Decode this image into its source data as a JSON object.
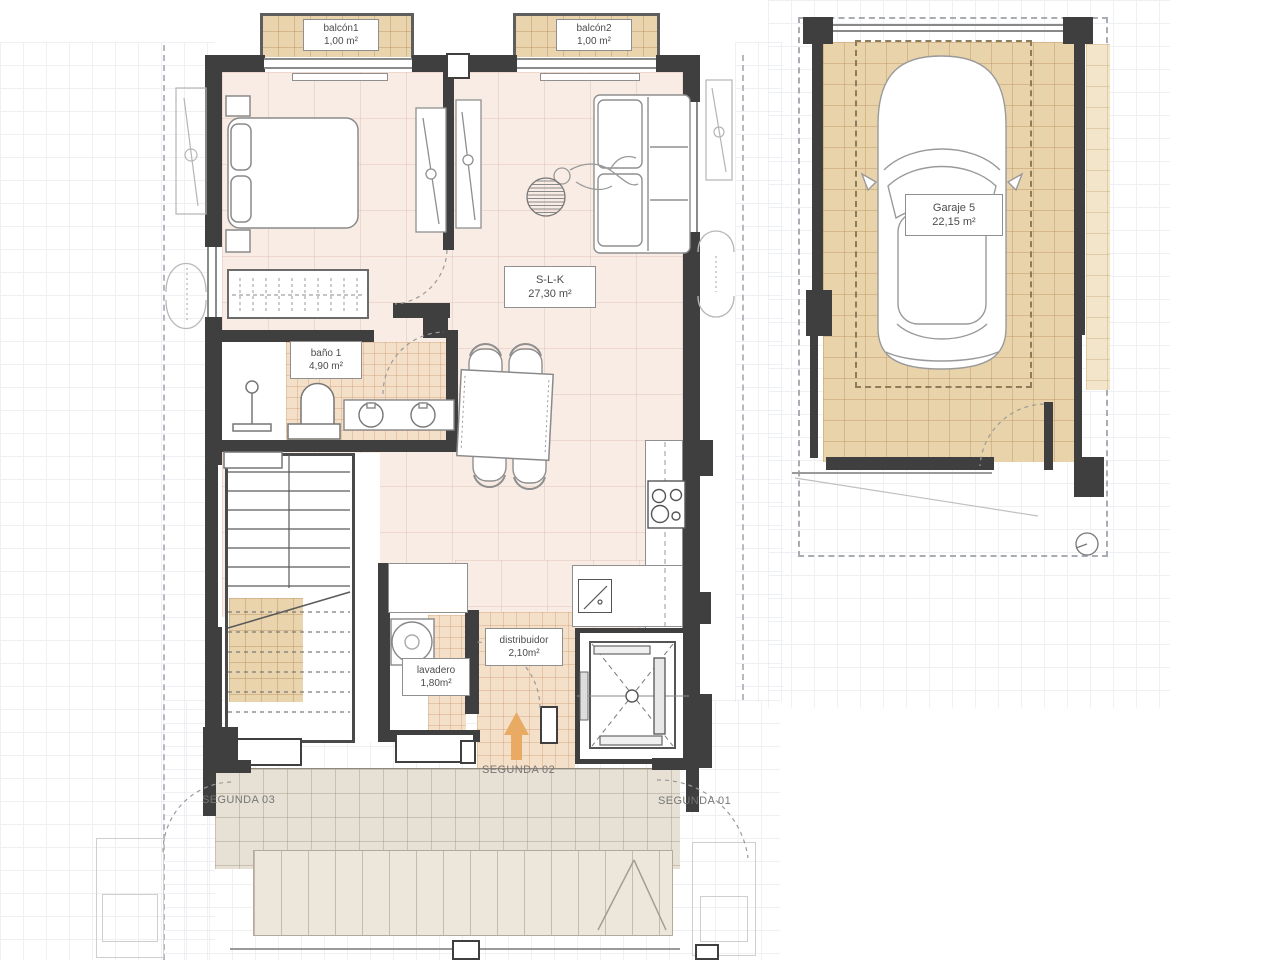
{
  "rooms": {
    "balcon1": {
      "name": "balcón1",
      "area": "1,00 m²"
    },
    "balcon2": {
      "name": "balcón2",
      "area": "1,00 m²"
    },
    "slk": {
      "name": "S-L-K",
      "area": "27,30 m²"
    },
    "bano1": {
      "name": "baño 1",
      "area": "4,90 m²"
    },
    "lavadero": {
      "name": "lavadero",
      "area": "1,80m²"
    },
    "distribuidor": {
      "name": "distribuidor",
      "area": "2,10m²"
    },
    "garaje": {
      "name": "Garaje 5",
      "area": "22,15 m²"
    }
  },
  "annotations": {
    "segunda01": "SEGUNDA 01",
    "segunda02": "SEGUNDA 02",
    "segunda03": "SEGUNDA 03"
  },
  "colors": {
    "apartment_floor": "#f8ece4",
    "tile_floor": "#f4dfc9",
    "balcony_floor": "#e9d4ad",
    "garage_floor": "#e9d3aa",
    "terrace_floor": "#e7e0d4",
    "wall": "#3f3f3f",
    "arrow": "#e9aa63"
  }
}
